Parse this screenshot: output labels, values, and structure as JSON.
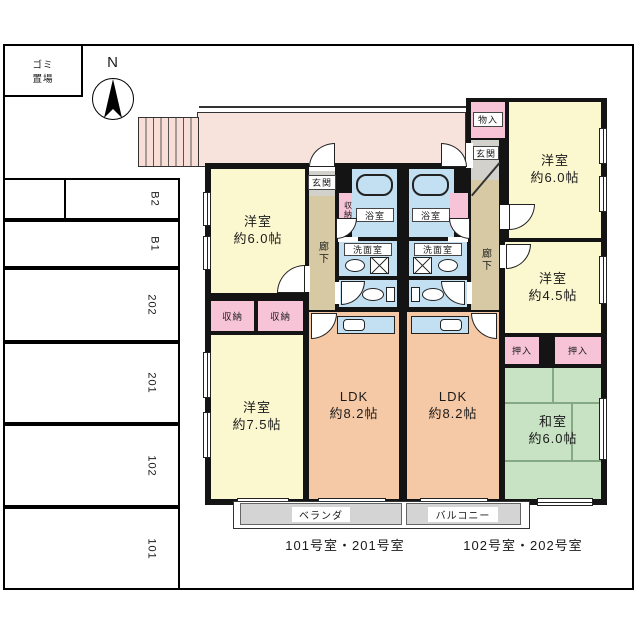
{
  "site": {
    "garbage1": "ゴミ",
    "garbage2": "置場",
    "north": "N",
    "parking_spaces": [
      "B2",
      "B1",
      "202",
      "201",
      "102",
      "101"
    ]
  },
  "common": {
    "veranda": "ベランダ",
    "balcony": "バルコニー"
  },
  "units": {
    "left": {
      "caption": "101号室・201号室",
      "rooms": {
        "bedroom6": {
          "name": "洋室",
          "size": "約6.0帖"
        },
        "bedroom75": {
          "name": "洋室",
          "size": "約7.5帖"
        },
        "ldk": {
          "name": "LDK",
          "size": "約8.2帖"
        },
        "entrance": "玄関",
        "hallway": "廊下",
        "hall_closet": "収納",
        "bath": "浴室",
        "washroom": "洗面室",
        "closet1": "収納",
        "closet2": "収納"
      }
    },
    "right": {
      "caption": "102号室・202号室",
      "rooms": {
        "storage": "物入",
        "entrance": "玄関",
        "hallway": "廊下",
        "bath": "浴室",
        "washroom": "洗面室",
        "bedroom6": {
          "name": "洋室",
          "size": "約6.0帖"
        },
        "bedroom45": {
          "name": "洋室",
          "size": "約4.5帖"
        },
        "oshiire1": "押入",
        "oshiire2": "押入",
        "washitsu": {
          "name": "和室",
          "size": "約6.0帖"
        },
        "ldk": {
          "name": "LDK",
          "size": "約8.2帖"
        }
      }
    }
  },
  "colors": {
    "bedroom_yellow": "#fbf7cf",
    "ldk_salmon": "#f6c9a6",
    "tatami_green": "#c8e2c4",
    "closet_pink": "#f7c3d6",
    "corridor_pink": "#f8e2dc",
    "water_blue": "#c3e0f2",
    "hallway_beige": "#d6c9a3",
    "entrance_gray": "#d2d1cb",
    "balcony_gray": "#d4d4d4",
    "wall_black": "#141414"
  }
}
